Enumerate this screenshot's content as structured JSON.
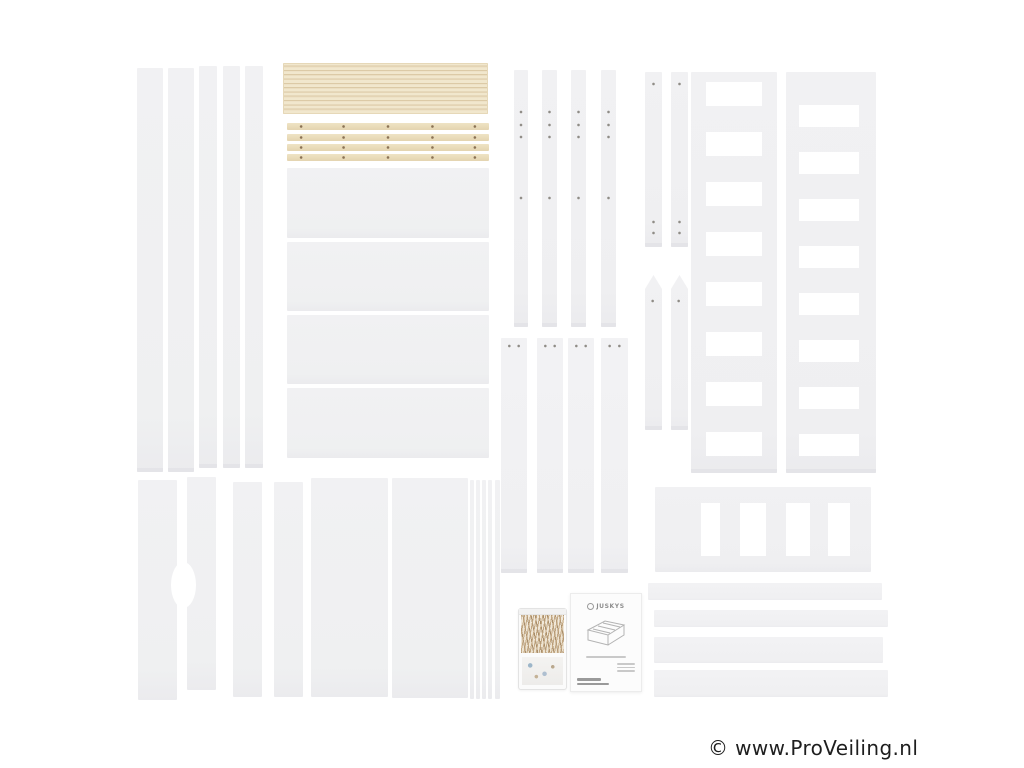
{
  "photo": {
    "description": "Product photograph: disassembled white children's house/loft bed kit with natural wood slats, hardware bag and assembly manual laid out on a white background",
    "background": "#ffffff"
  },
  "manual": {
    "brand": "JUSKYS"
  },
  "watermark": {
    "text": "© www.ProVeiling.nl",
    "color": "#1e1e1e"
  },
  "colors": {
    "part_fill": "#f0f0f2",
    "part_edge": "#e4e4e8",
    "wood_fill": "#ebdec1",
    "wood_line": "#dccaa6",
    "screw_hole": "#8f8c86"
  },
  "parts": {
    "left_boards": "five long white side boards",
    "slat_stack": "stack of natural wood bed slats",
    "slat_bars": "four wood slat support rails with screw holes",
    "mid_panels": "four white headboard panels",
    "mid_posts": "four narrow white bed posts with screw holes",
    "mid_boards": "four white frame boards",
    "short_sticks": "two short white battens",
    "pointed_sticks": "two pointed white roof battens",
    "ladders": "two white ladder / gable frames",
    "guard_rail": "white safety guard rail with balusters",
    "bottom_right_boards": "four long white horizontal boards",
    "bottom_left_panels": "white panels, two with oval grip cutout",
    "bottom_mid_panels": "two wide white panels and edge-on panel stack",
    "hardware_bag": "plastic bag with screws and fittings",
    "manual_booklet": "Juskys assembly instruction booklet"
  }
}
